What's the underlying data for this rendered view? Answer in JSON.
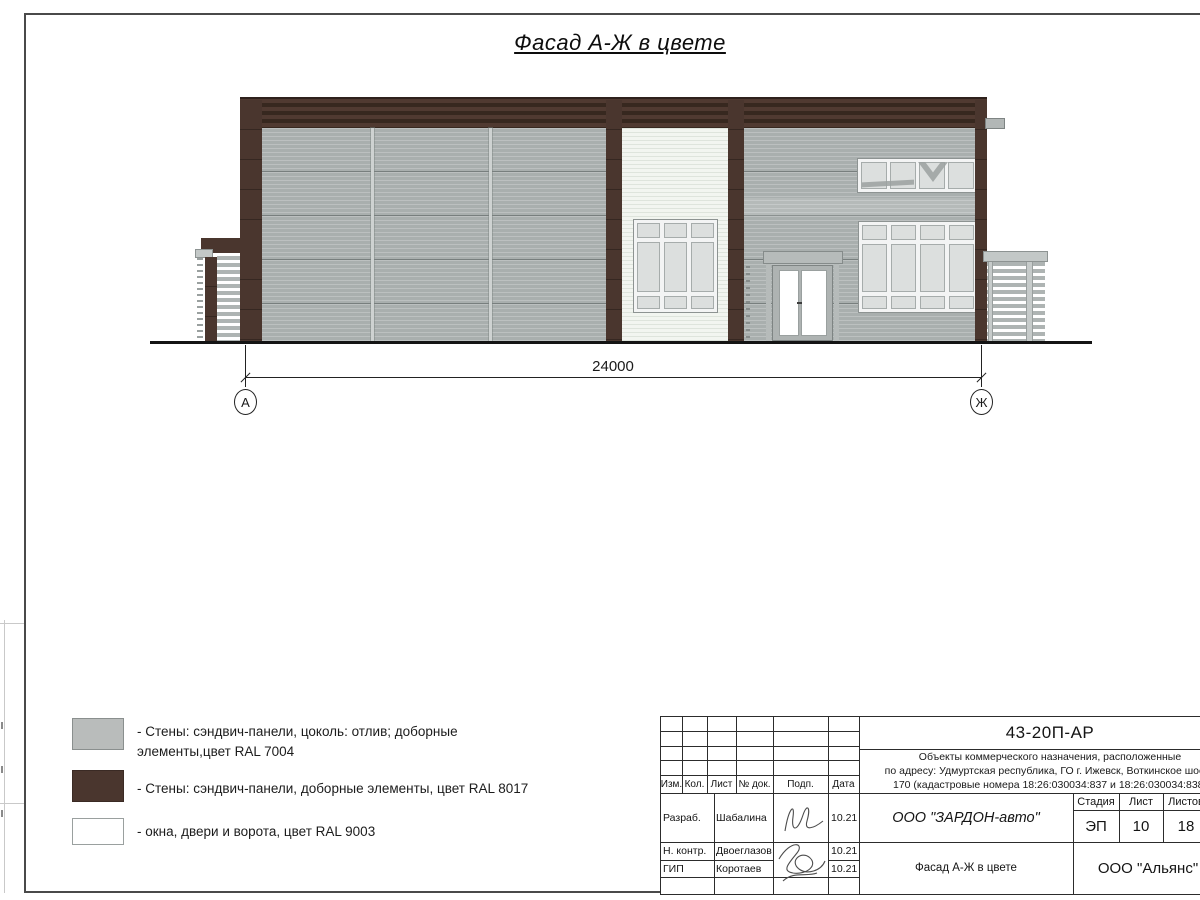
{
  "sheet": {
    "title": "Фасад А-Ж в цвете"
  },
  "drawing": {
    "dimension": "24000",
    "axes": {
      "left": "А",
      "right": "Ж"
    }
  },
  "legend": [
    {
      "color": "#b9bcbb",
      "label": "- Стены: сэндвич-панели, цоколь: отлив; доборные элементы,цвет RAL 7004"
    },
    {
      "color": "#4a362e",
      "label": "- Стены: сэндвич-панели, доборные элементы, цвет RAL 8017"
    },
    {
      "color": "#ffffff",
      "label": "- окна, двери и ворота, цвет RAL 9003"
    }
  ],
  "title_block": {
    "doc_number": "43-20П-АР",
    "description_lines": [
      "Объекты коммерческого назначения, расположенные",
      "по адресу: Удмуртская республика, ГО г. Ижевск, Воткинское шоссе",
      "170 (кадастровые номера 18:26:030034:837 и 18:26:030034:838)"
    ],
    "rev_headers": [
      "Изм.",
      "Кол.",
      "Лист",
      "№ док.",
      "Подп.",
      "Дата"
    ],
    "roles": [
      {
        "role": "Разраб.",
        "name": "Шабалина",
        "date": "10.21"
      },
      {
        "role": "Н. контр.",
        "name": "Двоеглазов",
        "date": "10.21"
      },
      {
        "role": "ГИП",
        "name": "Коротаев",
        "date": "10.21"
      }
    ],
    "company": "ООО \"ЗАРДОН-авто\"",
    "stage": {
      "header": "Стадия",
      "value": "ЭП"
    },
    "sheet_no": {
      "header": "Лист",
      "value": "10"
    },
    "sheets_total": {
      "header": "Листов",
      "value": "18"
    },
    "drawing_title": "Фасад А-Ж в цвете",
    "org": "ООО \"Альянс\""
  },
  "colors": {
    "wall_gray_ral7004": "#a9afae",
    "brown_ral8017": "#4a362e",
    "white_ral9003": "#f2f5f0"
  }
}
